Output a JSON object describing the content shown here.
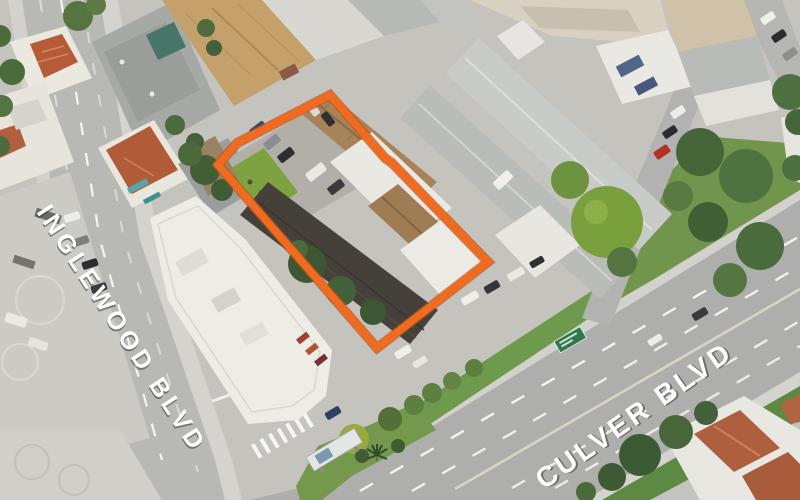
{
  "street_labels": {
    "inglewood": "INGLEWOOD BLVD",
    "culver": "CULVER BLVD"
  },
  "label_style": {
    "color": "#FFFFFF"
  },
  "parcel": {
    "outline_points": "330,95 385,158 392,163 488,262 377,348 218,165 237,143",
    "outline_color": "#EE6B20",
    "outline_underlay_color": "#C2521A"
  },
  "street_sign": {
    "fill": "#2F7A4C"
  }
}
